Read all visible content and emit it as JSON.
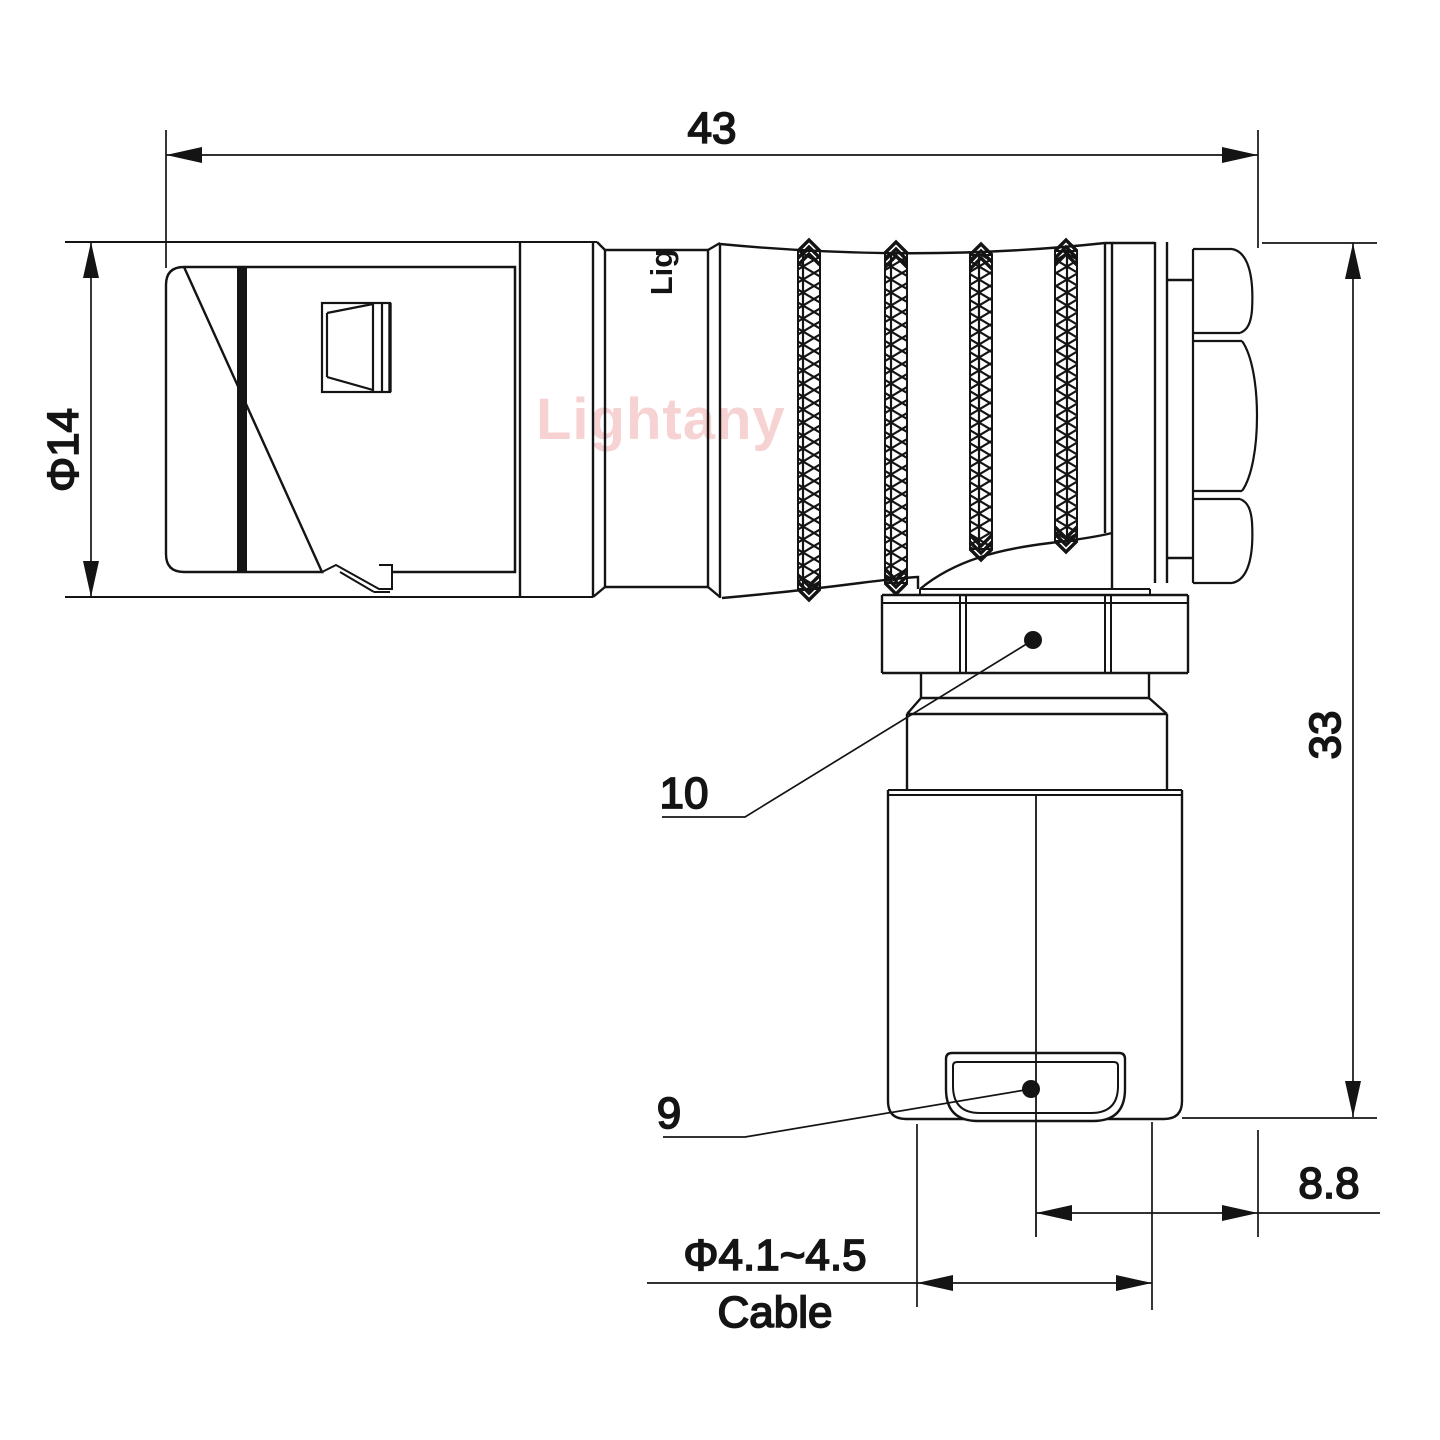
{
  "watermark": {
    "text": "Lightany",
    "color": "#f6d2d2"
  },
  "part_marking": {
    "text": "Lig"
  },
  "drawing": {
    "line_color": "#141414",
    "background": "#ffffff",
    "view": "right-angle connector side view"
  },
  "dimensions": {
    "overall_length": {
      "value": "43"
    },
    "front_diameter": {
      "value": "Φ14"
    },
    "height": {
      "value": "33"
    },
    "rear_offset": {
      "value": "8.8"
    },
    "cable_range": {
      "value": "Φ4.1~4.5",
      "label": "Cable"
    }
  },
  "callouts": {
    "nut": {
      "value": "10"
    },
    "clamp": {
      "value": "9"
    }
  }
}
